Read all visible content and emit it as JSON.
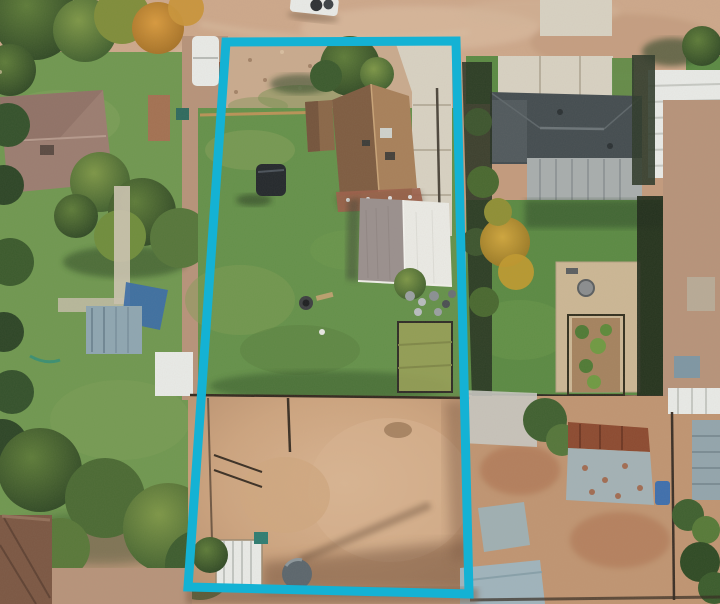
{
  "window": {
    "title": "Aerial drone photo - residential lot with boundary overlay"
  },
  "overlay": {
    "label": "property-lot-boundary",
    "points": "226,42 456,41 469,594 188,587",
    "stroke_width": 9,
    "color": "#14b2d4"
  },
  "colors": {
    "cyan": "#14b2d4",
    "dirtBase": "#c39b7d",
    "dirtRoad": "#cda88b",
    "dirtStrip": "#b7937a",
    "dirtShadow": "#7a5a42",
    "grassMain": "#64914a",
    "grassLeft": "#6f9850",
    "grassRight": "#5a8a43",
    "grassLight": "#8aa65c",
    "treeDark": "#2c4526",
    "treeMid": "#48682f",
    "treeLight": "#6f8d3c",
    "treeYellow": "#b5942f",
    "treeOrange": "#c68c33",
    "roofBrownLeft": "#7e5c41",
    "roofBrownRight": "#a8805a",
    "roofMauve": "#9b7d71",
    "roofCharcoal": "#434c50",
    "roofGray": "#a8aeae",
    "metalWhite": "#e9ebe8",
    "workshopGray": "#9a908e",
    "concrete": "#d8d2c3",
    "rust": "#8c4a30",
    "metalBlue": "#a3b2b6",
    "tankGray": "#5b666d",
    "brick": "#9c5f4a",
    "shedBrown": "#7b5743",
    "tarpBlue": "#3a6ca8",
    "fenceDark": "#4a3a2c",
    "rustFence": "#8a4a33"
  },
  "scene": {
    "type": "aerial-drone-photograph",
    "features": [
      {
        "name": "dirt-road",
        "desc": "unpaved road across top"
      },
      {
        "name": "parked-truck-road",
        "desc": "white vehicle on road, top center"
      },
      {
        "name": "subject-lot",
        "desc": "lot inside cyan boundary: lawn, house, workshop, dirt corral"
      },
      {
        "name": "main-house",
        "desc": "brown shingle gable roof house"
      },
      {
        "name": "workshop",
        "desc": "gray/white gable metal roof outbuilding"
      },
      {
        "name": "corral",
        "desc": "dirt horse pen with fencing, white shed, round tank"
      },
      {
        "name": "left-neighbor",
        "desc": "mauve hip-roof house, large trees, lawn, sheds"
      },
      {
        "name": "right-neighbor",
        "desc": "charcoal hip-roof house, white carport, patio, garden"
      },
      {
        "name": "bottom-right-yard",
        "desc": "dirt yard with rusty metal barn and sheds"
      }
    ]
  }
}
